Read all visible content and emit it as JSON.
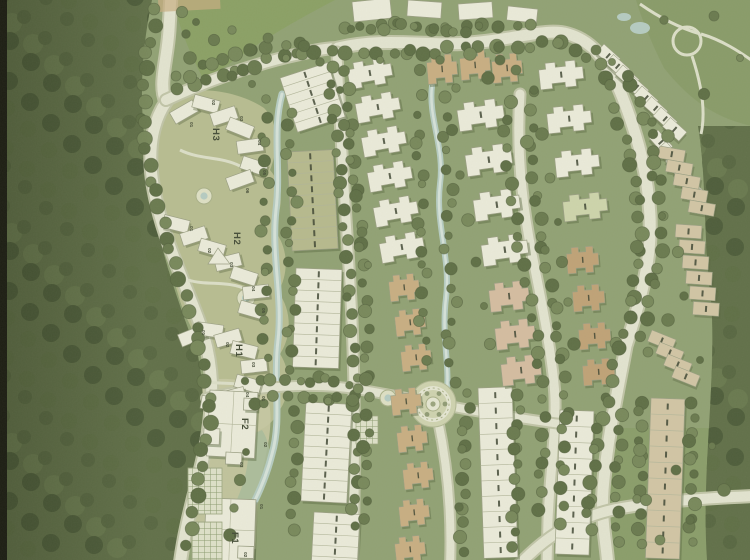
{
  "map": {
    "kind": "residential master plan (scanned rendering)",
    "plots": [
      {
        "id": "H3",
        "label": "H3",
        "units": [
          "01",
          "02",
          "03",
          "04",
          "05",
          "06"
        ]
      },
      {
        "id": "H2",
        "label": "H2",
        "units": [
          "01",
          "02",
          "03",
          "04",
          "05"
        ]
      },
      {
        "id": "H1",
        "label": "H1",
        "units": [
          "01",
          "02",
          "03",
          "04"
        ]
      },
      {
        "id": "F2",
        "label": "F2",
        "units": [
          "01",
          "02",
          "03"
        ]
      },
      {
        "id": "F1",
        "label": "F1",
        "units": [
          "01",
          "02"
        ]
      }
    ]
  },
  "colors": {
    "paper": "#8fa173",
    "forest": "#5c6d46",
    "forest2": "#52633e",
    "forest3": "#465735",
    "canopy": "#66784c",
    "canopy2": "#5a6c43",
    "canopy3": "#748659",
    "lawn_pale": "#b9bf94",
    "lawn_bright": "#85a05f",
    "park_lawn": "#7f965e",
    "court": "#c9cba6",
    "road": "#e4e6d3",
    "road_edge": "#c0c6a9",
    "path": "#dde1cb",
    "b_white": "#edeede",
    "b_olive": "#b6ba8e",
    "b_tan": "#c9ae82",
    "b_tan_light": "#d2c7a6",
    "b_pink": "#d5bda2",
    "b_brown": "#bfa276",
    "b_green": "#ced6ad",
    "b_stroke": "#999f84",
    "shadow": "#55653f",
    "stream": "#b5cdc5",
    "stream_core": "#d6e4dd",
    "wetland": "#a9bb9b",
    "label": "#3f4834",
    "chip": "#3a4230",
    "scan_edge": "#15160f"
  }
}
